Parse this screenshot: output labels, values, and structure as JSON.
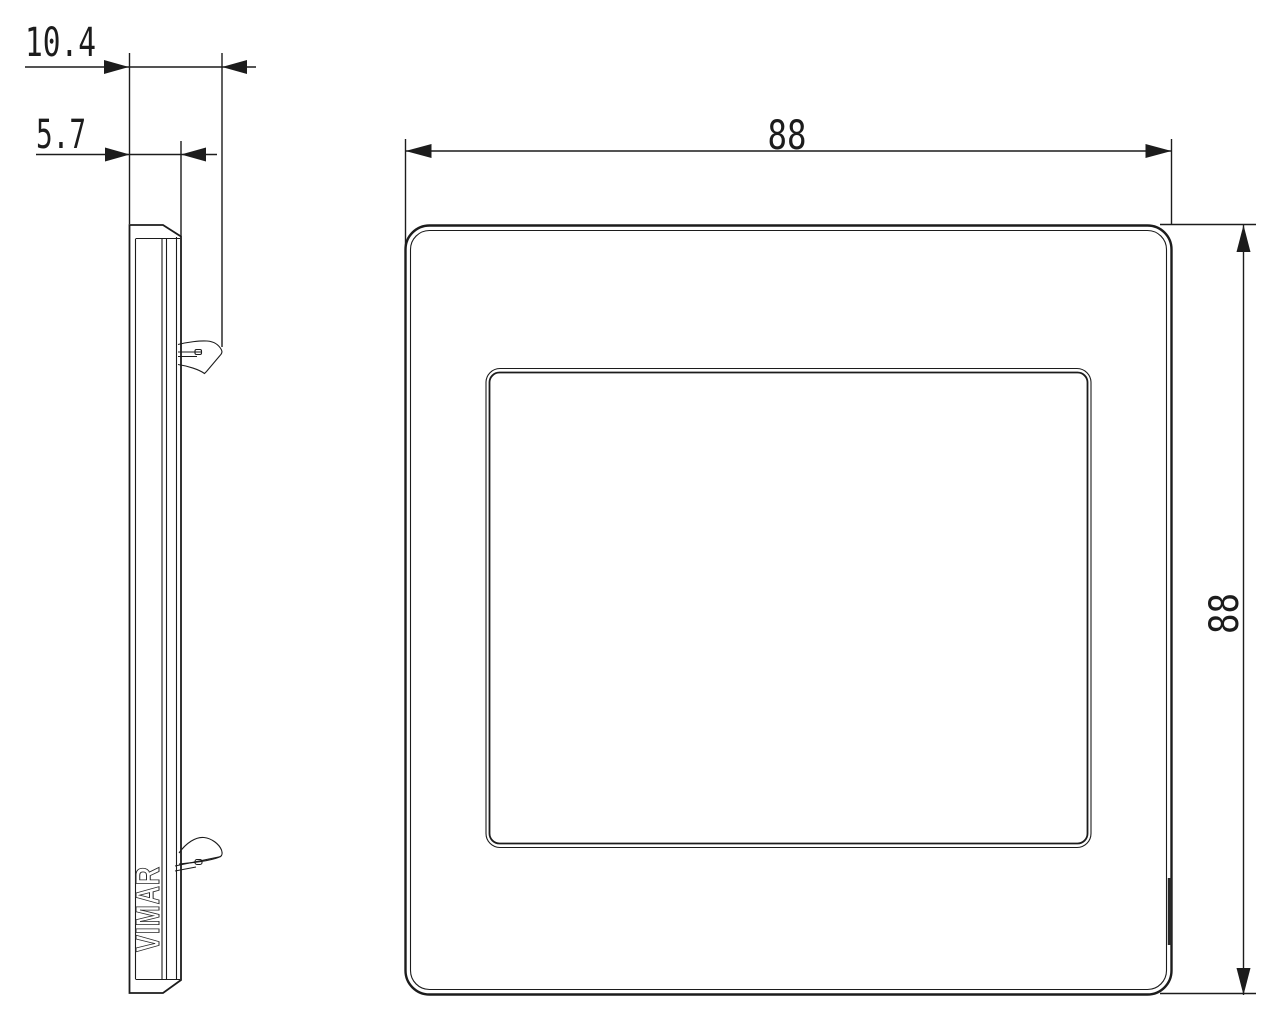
{
  "drawing": {
    "kind": "technical-dimension-drawing",
    "brand_logo": "VIMAR",
    "dimensions": {
      "total_depth": "10.4",
      "plate_depth": "5.7",
      "width": "88",
      "height": "88"
    },
    "colors": {
      "line": "#1c1c1c",
      "background": "#ffffff"
    }
  }
}
